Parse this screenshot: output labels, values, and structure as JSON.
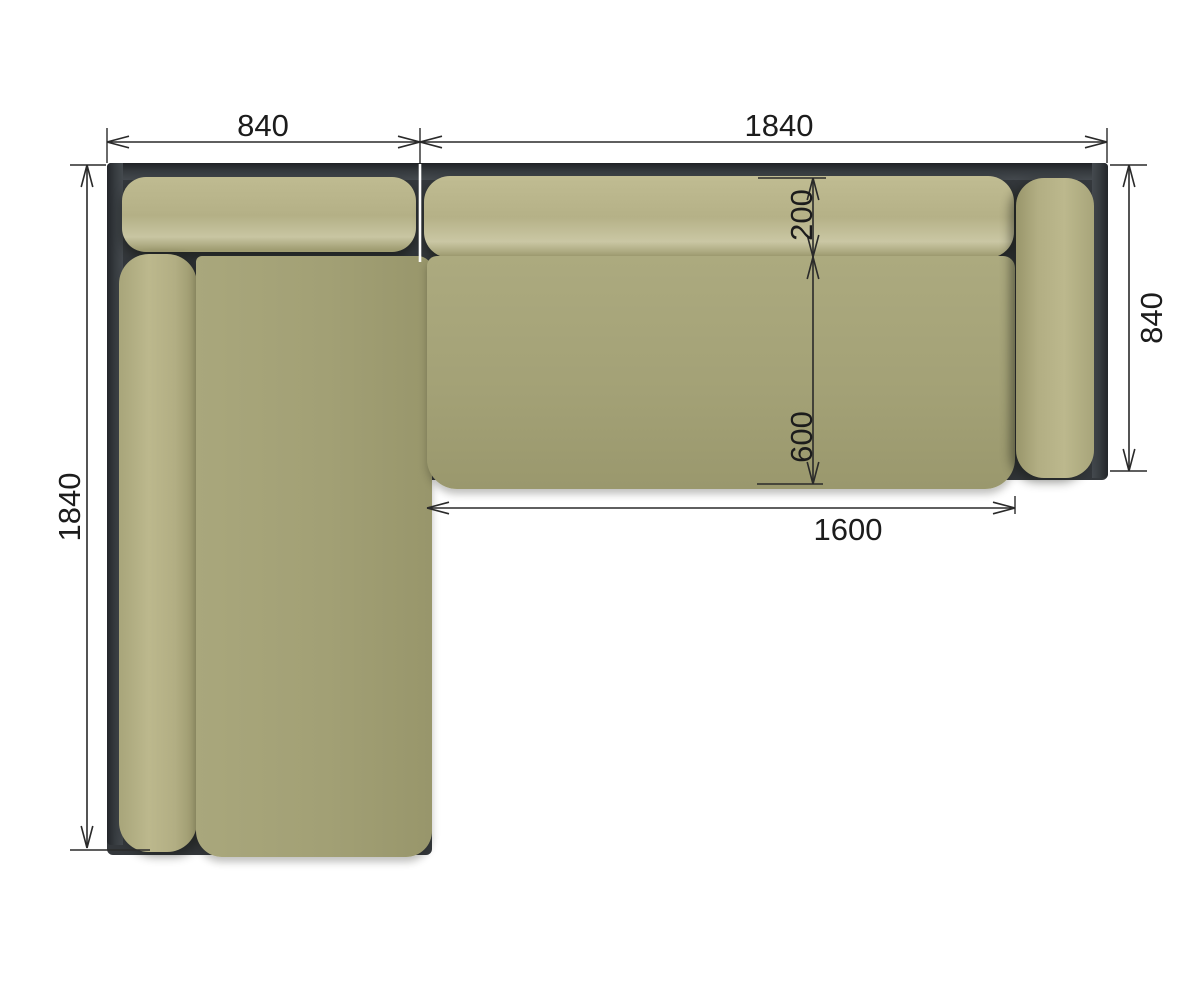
{
  "drawing": {
    "subject": "corner-sofa-top-view",
    "units_note": "",
    "dims": {
      "chaise_width": "840",
      "sofa_width": "1840",
      "left_depth": "1840",
      "right_depth": "840",
      "back_cushion_depth": "200",
      "seat_depth": "600",
      "seat_length": "1600"
    },
    "colors": {
      "frame": "#34383c",
      "cushion_light": "#b7b389",
      "cushion_dark": "#a3a176",
      "dimension_line": "#2a2a2a",
      "background": "#ffffff"
    }
  }
}
